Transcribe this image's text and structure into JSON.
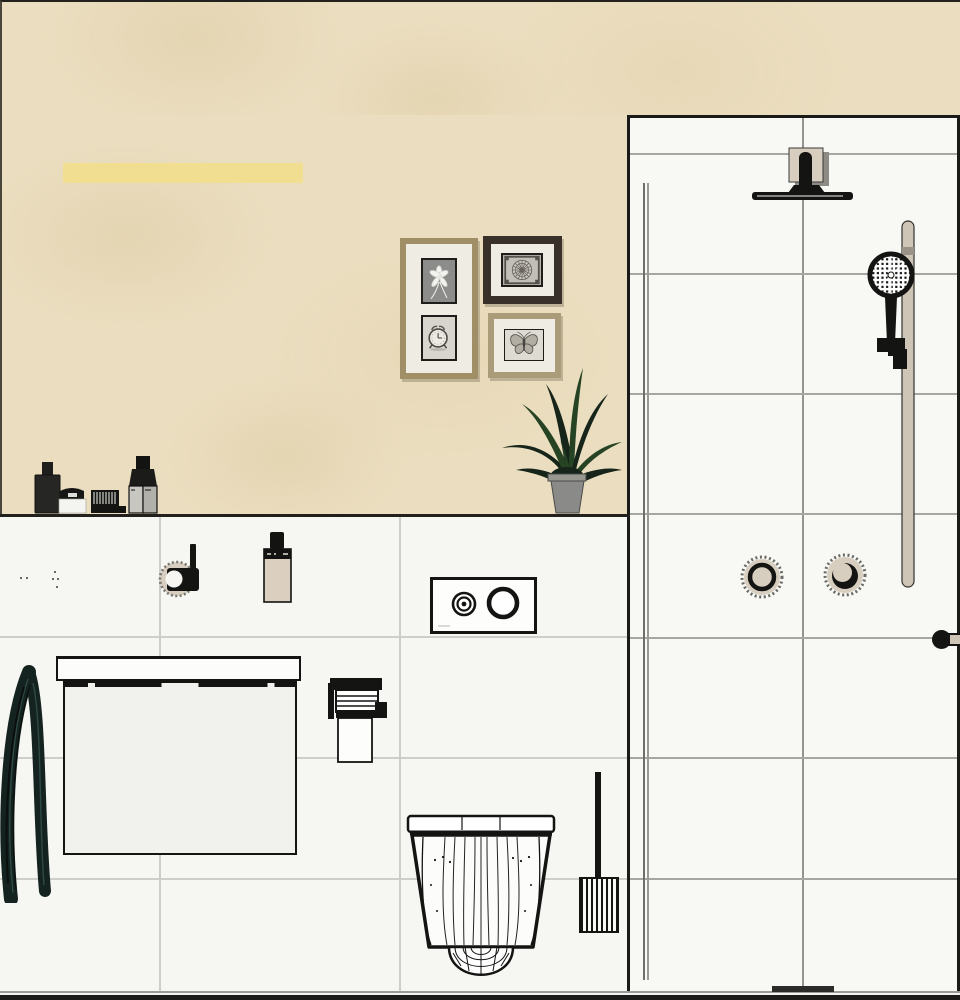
{
  "meta": {
    "description": "Bathroom interior elevation rendering (design-software visualization), no visible text",
    "canvas": {
      "width": 960,
      "height": 1000
    }
  },
  "palette": {
    "wall_beige": "#EBDEC0",
    "accent_yellow": "#F2DE90",
    "tile_left": "#F6F6F3",
    "tile_shower": "#F8F8F5",
    "grout_left": "#CDCDC9",
    "grout_shower": "#A6A6A2",
    "ink": "#141412",
    "floor_dark": "#1B1B19",
    "towel_green": "#152320",
    "towel_highlight": "#2E4A42",
    "plant_dark": "#16241A",
    "plant_green": "#264323",
    "pot_gray": "#8A8A88",
    "frame_gold": "#A08E67",
    "frame_dark": "#39302A",
    "frame_tan": "#AB9C79",
    "mat_white": "#EFECE3",
    "beige_fixture": "#D8CEBF",
    "rail_tan": "#CEC5B7"
  },
  "regions": {
    "wall_upper": [
      0,
      0,
      960,
      115
    ],
    "wall_left": [
      0,
      115,
      627,
      400
    ],
    "ledge_line": [
      0,
      514,
      630,
      3
    ],
    "tile_left": [
      0,
      517,
      627,
      476
    ],
    "shower": [
      627,
      115,
      333,
      878
    ],
    "glass_a": [
      643,
      183,
      2,
      797
    ],
    "glass_b": [
      647,
      183,
      2,
      797
    ],
    "floor_grey": [
      0,
      991,
      960,
      2
    ],
    "floor_white": [
      0,
      993,
      960,
      2
    ],
    "floor_band": [
      0,
      995,
      960,
      5
    ],
    "drain": [
      772,
      986,
      62,
      6
    ]
  },
  "tiles": {
    "left": {
      "verticals": [
        159,
        399
      ],
      "v_span": [
        517,
        992
      ],
      "horizontals": [
        636,
        757,
        878
      ],
      "h_span": [
        0,
        627
      ]
    },
    "shower": {
      "verticals": [
        802
      ],
      "v_span": [
        118,
        991
      ],
      "horizontals": [
        153,
        273,
        393,
        513,
        637,
        757,
        878
      ],
      "h_span": [
        630,
        957
      ]
    }
  },
  "objects": {
    "light_bar": [
      63,
      163,
      240,
      20
    ],
    "frame_tall": [
      400,
      238,
      78,
      141
    ],
    "frame_square": [
      483,
      236,
      79,
      68
    ],
    "frame_wide": [
      488,
      313,
      73,
      65
    ],
    "plant": [
      496,
      358,
      130,
      157
    ],
    "ledge_items": [
      20,
      438,
      160,
      80
    ],
    "towel": [
      0,
      663,
      58,
      240
    ],
    "vanity_counter": [
      56,
      656,
      245,
      25
    ],
    "vanity_body": [
      63,
      681,
      234,
      174
    ],
    "valve": [
      154,
      540,
      50,
      58
    ],
    "soap_bottle": [
      263,
      530,
      30,
      74
    ],
    "flush_plate": [
      430,
      577,
      107,
      57
    ],
    "tp_holder": [
      325,
      674,
      65,
      90
    ],
    "toilet": [
      405,
      813,
      152,
      167
    ],
    "brush_handle": [
      595,
      772,
      6,
      106
    ],
    "brush_holder": [
      579,
      877,
      40,
      56
    ],
    "rain_shower": [
      745,
      140,
      115,
      65
    ],
    "rail": [
      901,
      220,
      14,
      368
    ],
    "hand_shower": [
      862,
      248,
      60,
      125
    ],
    "knob_left": [
      738,
      553,
      48,
      48
    ],
    "knob_right": [
      821,
      551,
      48,
      48
    ],
    "towel_bar_knob": [
      932,
      630,
      19,
      19
    ],
    "towel_bar_rail": [
      948,
      633,
      12,
      13
    ]
  },
  "specks": [
    [
      20,
      577
    ],
    [
      26,
      577
    ],
    [
      54,
      571
    ],
    [
      52,
      578
    ],
    [
      57,
      578
    ],
    [
      56,
      586
    ]
  ],
  "icons": {
    "pictures": [
      "flower-photo",
      "alarm-clock-photo",
      "rosette-medallion-photo",
      "butterfly-photo"
    ],
    "fixtures": [
      "rain-shower-head",
      "hand-shower",
      "shower-rail",
      "thermostat-knob",
      "diverter-knob",
      "flush-actuator-plate",
      "wall-hung-toilet",
      "toilet-brush",
      "toilet-paper-holder",
      "vanity-cabinet",
      "hanging-towel",
      "towel-bar",
      "wall-valve",
      "soap-bottle",
      "potted-plant"
    ]
  }
}
